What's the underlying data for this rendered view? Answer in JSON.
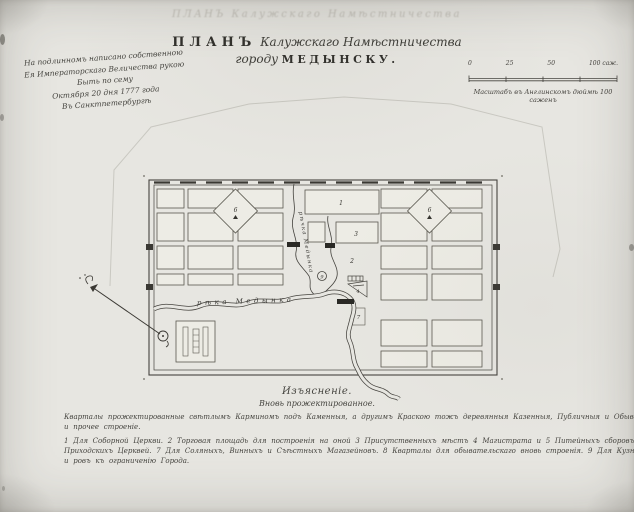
{
  "colors": {
    "ink": "#3b3a36",
    "paper": "#e7e6e1",
    "pencil": "#c9c8c1"
  },
  "document": {
    "ghost_title": "ПЛАНЪ Калужскаго Намѣстничества",
    "title": {
      "word_plan": "ПЛАНЪ",
      "province": "Калужскаго Намѣстничества",
      "town_prefix": "городу",
      "town_name": "МЕДЫНСКУ."
    },
    "imperial_note": {
      "lines": [
        "На подлинномъ написано собственною",
        "Ея Императорскаго Величества рукою",
        "Быть по сему",
        "Октября 20 дня 1777 года",
        "Въ Санктпетербургѣ"
      ]
    },
    "scale_bar": {
      "ticks": [
        "0",
        "25",
        "50",
        "100 саж."
      ],
      "caption": "Масштабъ въ Англинскомъ дюймѣ 100 саженъ"
    }
  },
  "map": {
    "rivers": {
      "main": "рѣка Медынка",
      "upper": "рѣчка Медынка"
    },
    "numbers": {
      "n1": "1",
      "n2": "2",
      "n3": "3",
      "n4": "4",
      "n7": "7",
      "n9": "9",
      "diamond_left": "6",
      "diamond_right": "6"
    }
  },
  "legend": {
    "heading": "Изъясненіе.",
    "subheading": "Вновь прожектированное.",
    "para_line1": "Кварталы прожектированные свѣтлымъ Карминомъ подъ Каменныя, а другимъ Краскою тожъ деревянныя Казенныя, Публичныя и Обывательскія домы",
    "para_line2": "и прочее строеніе.",
    "items_line1": "1 Для Соборной Церкви. 2 Торговая площадь для построенія на оной 3 Присутственныхъ мѣстъ 4 Магистрата и 5 Питейныхъ сборовъ 6 Для",
    "items_line2": "Приходскихъ Церквей. 7 Для Соляныхъ, Винныхъ и Съѣстныхъ Магазейновъ. 8 Кварталы для обывательскаго вновь строенія. 9 Для Кузницъ 10 Валъ",
    "items_line3": "и ровъ къ ограниченію Города."
  }
}
